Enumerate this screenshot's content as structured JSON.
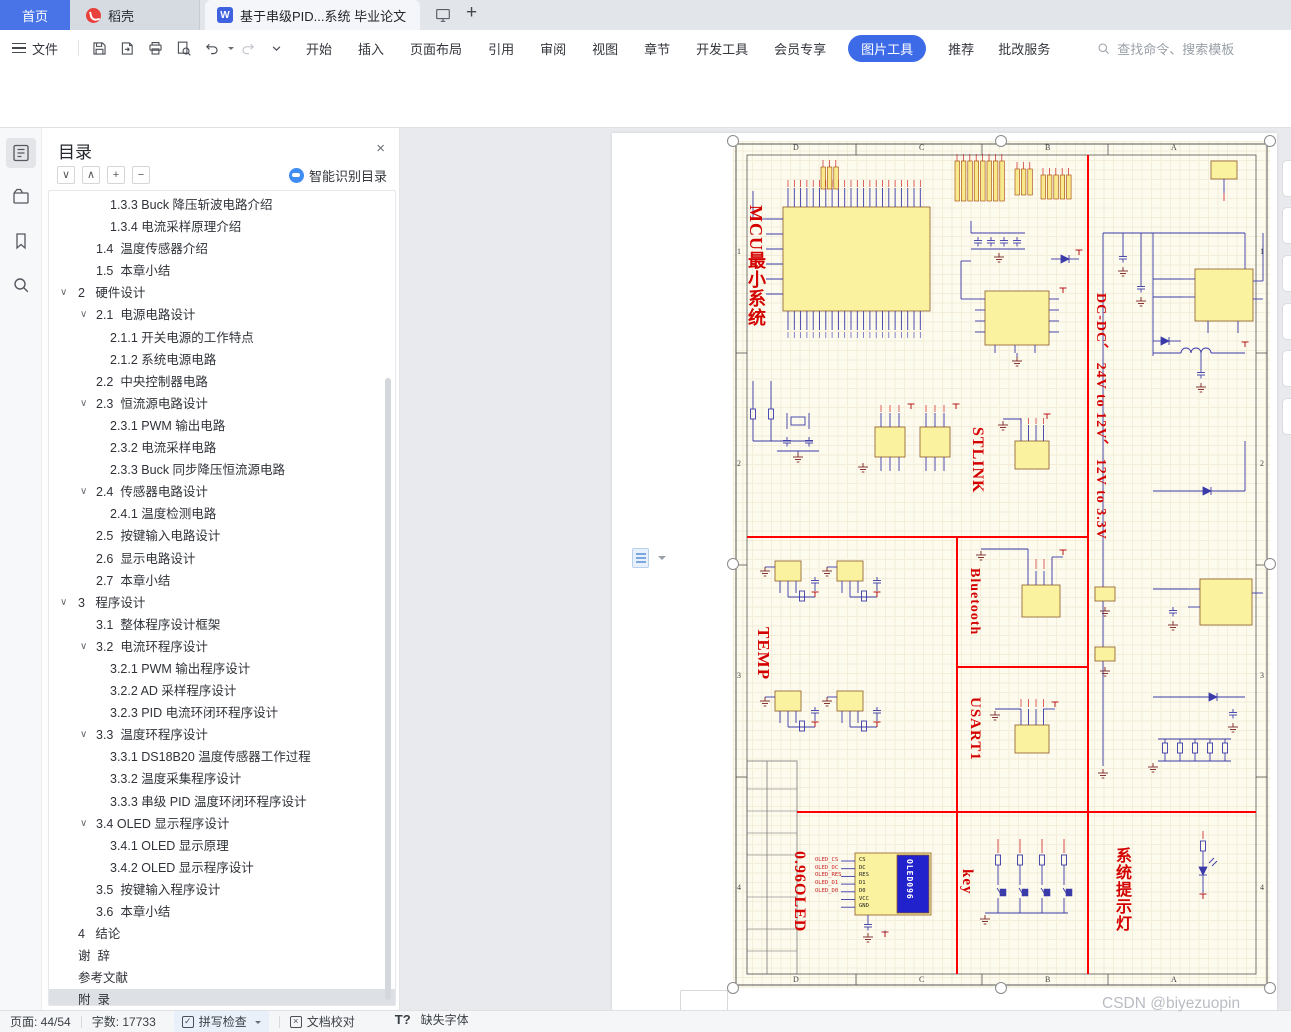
{
  "tab_bar": {
    "home": "首页",
    "docer": "稻壳",
    "document": "基于串级PID...系统 毕业论文",
    "doc_icon_letter": "W"
  },
  "menu_bar": {
    "file": "文件",
    "menus": [
      "开始",
      "插入",
      "页面布局",
      "引用",
      "审阅",
      "视图",
      "章节",
      "开发工具",
      "会员专享"
    ],
    "active_tool_tab": "图片工具",
    "extra_menus": [
      "推荐",
      "批改服务"
    ],
    "search_placeholder": "查找命令、搜索模板"
  },
  "toolbar": {
    "add_image": "添加图片",
    "replace_image": "替换图片",
    "insert_shape": "插入形状",
    "compress_image": "压缩图片",
    "clarify": "清晰化",
    "crop": "裁剪",
    "width_value": "22.34厘米",
    "height_value": "14.26厘米",
    "lock_aspect": "锁定纵横比",
    "lock_check": "✓",
    "reset_size": "重设大小",
    "remove_background": "抠除背景",
    "set_transparent": "设置透明色",
    "color": "色彩",
    "effects": "效果",
    "border": "边框",
    "reset_style": "重设样式",
    "rotate": "旋转",
    "group": "组合",
    "align": "对齐",
    "wrap": "环绕",
    "bring_forward": "上移一层",
    "send_backward": "下移一层",
    "selection_pane": "选择窗格",
    "batch_process": "批量处理"
  },
  "toc_panel": {
    "title": "目录",
    "smart_toc": "智能识别目录",
    "close_glyph": "×",
    "chevron_glyph": "∨",
    "tool_glyphs": [
      "∨",
      "∧",
      "+",
      "−"
    ],
    "items": [
      {
        "l": 3,
        "t": "1.3.3 Buck 降压斩波电路介绍"
      },
      {
        "l": 3,
        "t": "1.3.4 电流采样原理介绍"
      },
      {
        "l": 2,
        "t": "1.4  温度传感器介绍"
      },
      {
        "l": 2,
        "t": "1.5  本章小结"
      },
      {
        "l": 1,
        "c": 1,
        "t": "2   硬件设计"
      },
      {
        "l": 2,
        "c": 1,
        "t": "2.1  电源电路设计"
      },
      {
        "l": 3,
        "t": "2.1.1 开关电源的工作特点"
      },
      {
        "l": 3,
        "t": "2.1.2 系统电源电路"
      },
      {
        "l": 2,
        "t": "2.2  中央控制器电路"
      },
      {
        "l": 2,
        "c": 1,
        "t": "2.3  恒流源电路设计"
      },
      {
        "l": 3,
        "t": "2.3.1 PWM 输出电路"
      },
      {
        "l": 3,
        "t": "2.3.2 电流采样电路"
      },
      {
        "l": 3,
        "t": "2.3.3 Buck 同步降压恒流源电路"
      },
      {
        "l": 2,
        "c": 1,
        "t": "2.4  传感器电路设计"
      },
      {
        "l": 3,
        "t": "2.4.1 温度检测电路"
      },
      {
        "l": 2,
        "t": "2.5  按键输入电路设计"
      },
      {
        "l": 2,
        "t": "2.6  显示电路设计"
      },
      {
        "l": 2,
        "t": "2.7  本章小结"
      },
      {
        "l": 1,
        "c": 1,
        "t": "3   程序设计"
      },
      {
        "l": 2,
        "t": "3.1  整体程序设计框架"
      },
      {
        "l": 2,
        "c": 1,
        "t": "3.2  电流环程序设计"
      },
      {
        "l": 3,
        "t": "3.2.1 PWM 输出程序设计"
      },
      {
        "l": 3,
        "t": "3.2.2 AD 采样程序设计"
      },
      {
        "l": 3,
        "t": "3.2.3 PID 电流环闭环程序设计"
      },
      {
        "l": 2,
        "c": 1,
        "t": "3.3  温度环程序设计"
      },
      {
        "l": 3,
        "t": "3.3.1 DS18B20 温度传感器工作过程"
      },
      {
        "l": 3,
        "t": "3.3.2 温度采集程序设计"
      },
      {
        "l": 3,
        "t": "3.3.3 串级 PID 温度环闭环程序设计"
      },
      {
        "l": 2,
        "c": 1,
        "t": "3.4 OLED 显示程序设计"
      },
      {
        "l": 3,
        "t": "3.4.1 OLED 显示原理"
      },
      {
        "l": 3,
        "t": "3.4.2 OLED 显示程序设计"
      },
      {
        "l": 2,
        "t": "3.5  按键输入程序设计"
      },
      {
        "l": 2,
        "t": "3.6  本章小结"
      },
      {
        "l": 1,
        "t": "4   结论"
      },
      {
        "l": 1,
        "t": "谢  辞"
      },
      {
        "l": 1,
        "t": "参考文献"
      },
      {
        "l": 1,
        "t": "附  录",
        "sel": 1
      }
    ]
  },
  "status_bar": {
    "page": "页面: 44/54",
    "words": "字数: 17733",
    "spell_check": "拼写检查",
    "doc_proof": "文档校对",
    "missing_font": "缺失字体",
    "missing_font_glyph": "T?",
    "spell_glyph": "✓",
    "proof_glyph": "×"
  },
  "watermark": "CSDN @biyezuopin",
  "schematic": {
    "sections": [
      {
        "label": "MCU最小系统",
        "x": 14,
        "y": 64,
        "fs": 18
      },
      {
        "label": "DC-DC、 24V to 12V、 12V to 3.3V",
        "x": 360,
        "y": 152,
        "fs": 14
      },
      {
        "label": "STLINK",
        "x": 236,
        "y": 286,
        "fs": 16
      },
      {
        "label": "TEMP",
        "x": 22,
        "y": 486,
        "fs": 17
      },
      {
        "label": "Bluetooth",
        "x": 234,
        "y": 427,
        "fs": 14
      },
      {
        "label": "USART1",
        "x": 234,
        "y": 556,
        "fs": 15
      },
      {
        "label": "0.96OLED",
        "x": 58,
        "y": 710,
        "fs": 16
      },
      {
        "label": "key",
        "x": 226,
        "y": 728,
        "fs": 15
      },
      {
        "label": "系统提示灯",
        "x": 380,
        "y": 706,
        "fs": 16
      }
    ],
    "border_columns": [
      "D",
      "C",
      "B",
      "A"
    ],
    "border_rows": [
      "1",
      "2",
      "3",
      "4"
    ],
    "oled": {
      "chip_label": "OLED096",
      "pins": [
        "CS",
        "DC",
        "RES",
        "D1",
        "D0",
        "VCC",
        "GND"
      ],
      "net_labels": [
        "OLED_CS",
        "OLED_DC",
        "OLED_RES",
        "OLED_D1",
        "OLED_D0"
      ]
    },
    "colors": {
      "section_label": "#d40000",
      "divider": "#ff0000",
      "sheet": "#fdfaee",
      "wire": "#3a3aa8",
      "component_fill": "#fbf2a0",
      "component_stroke": "#8a5a2b",
      "ground": "#7a2020"
    }
  }
}
